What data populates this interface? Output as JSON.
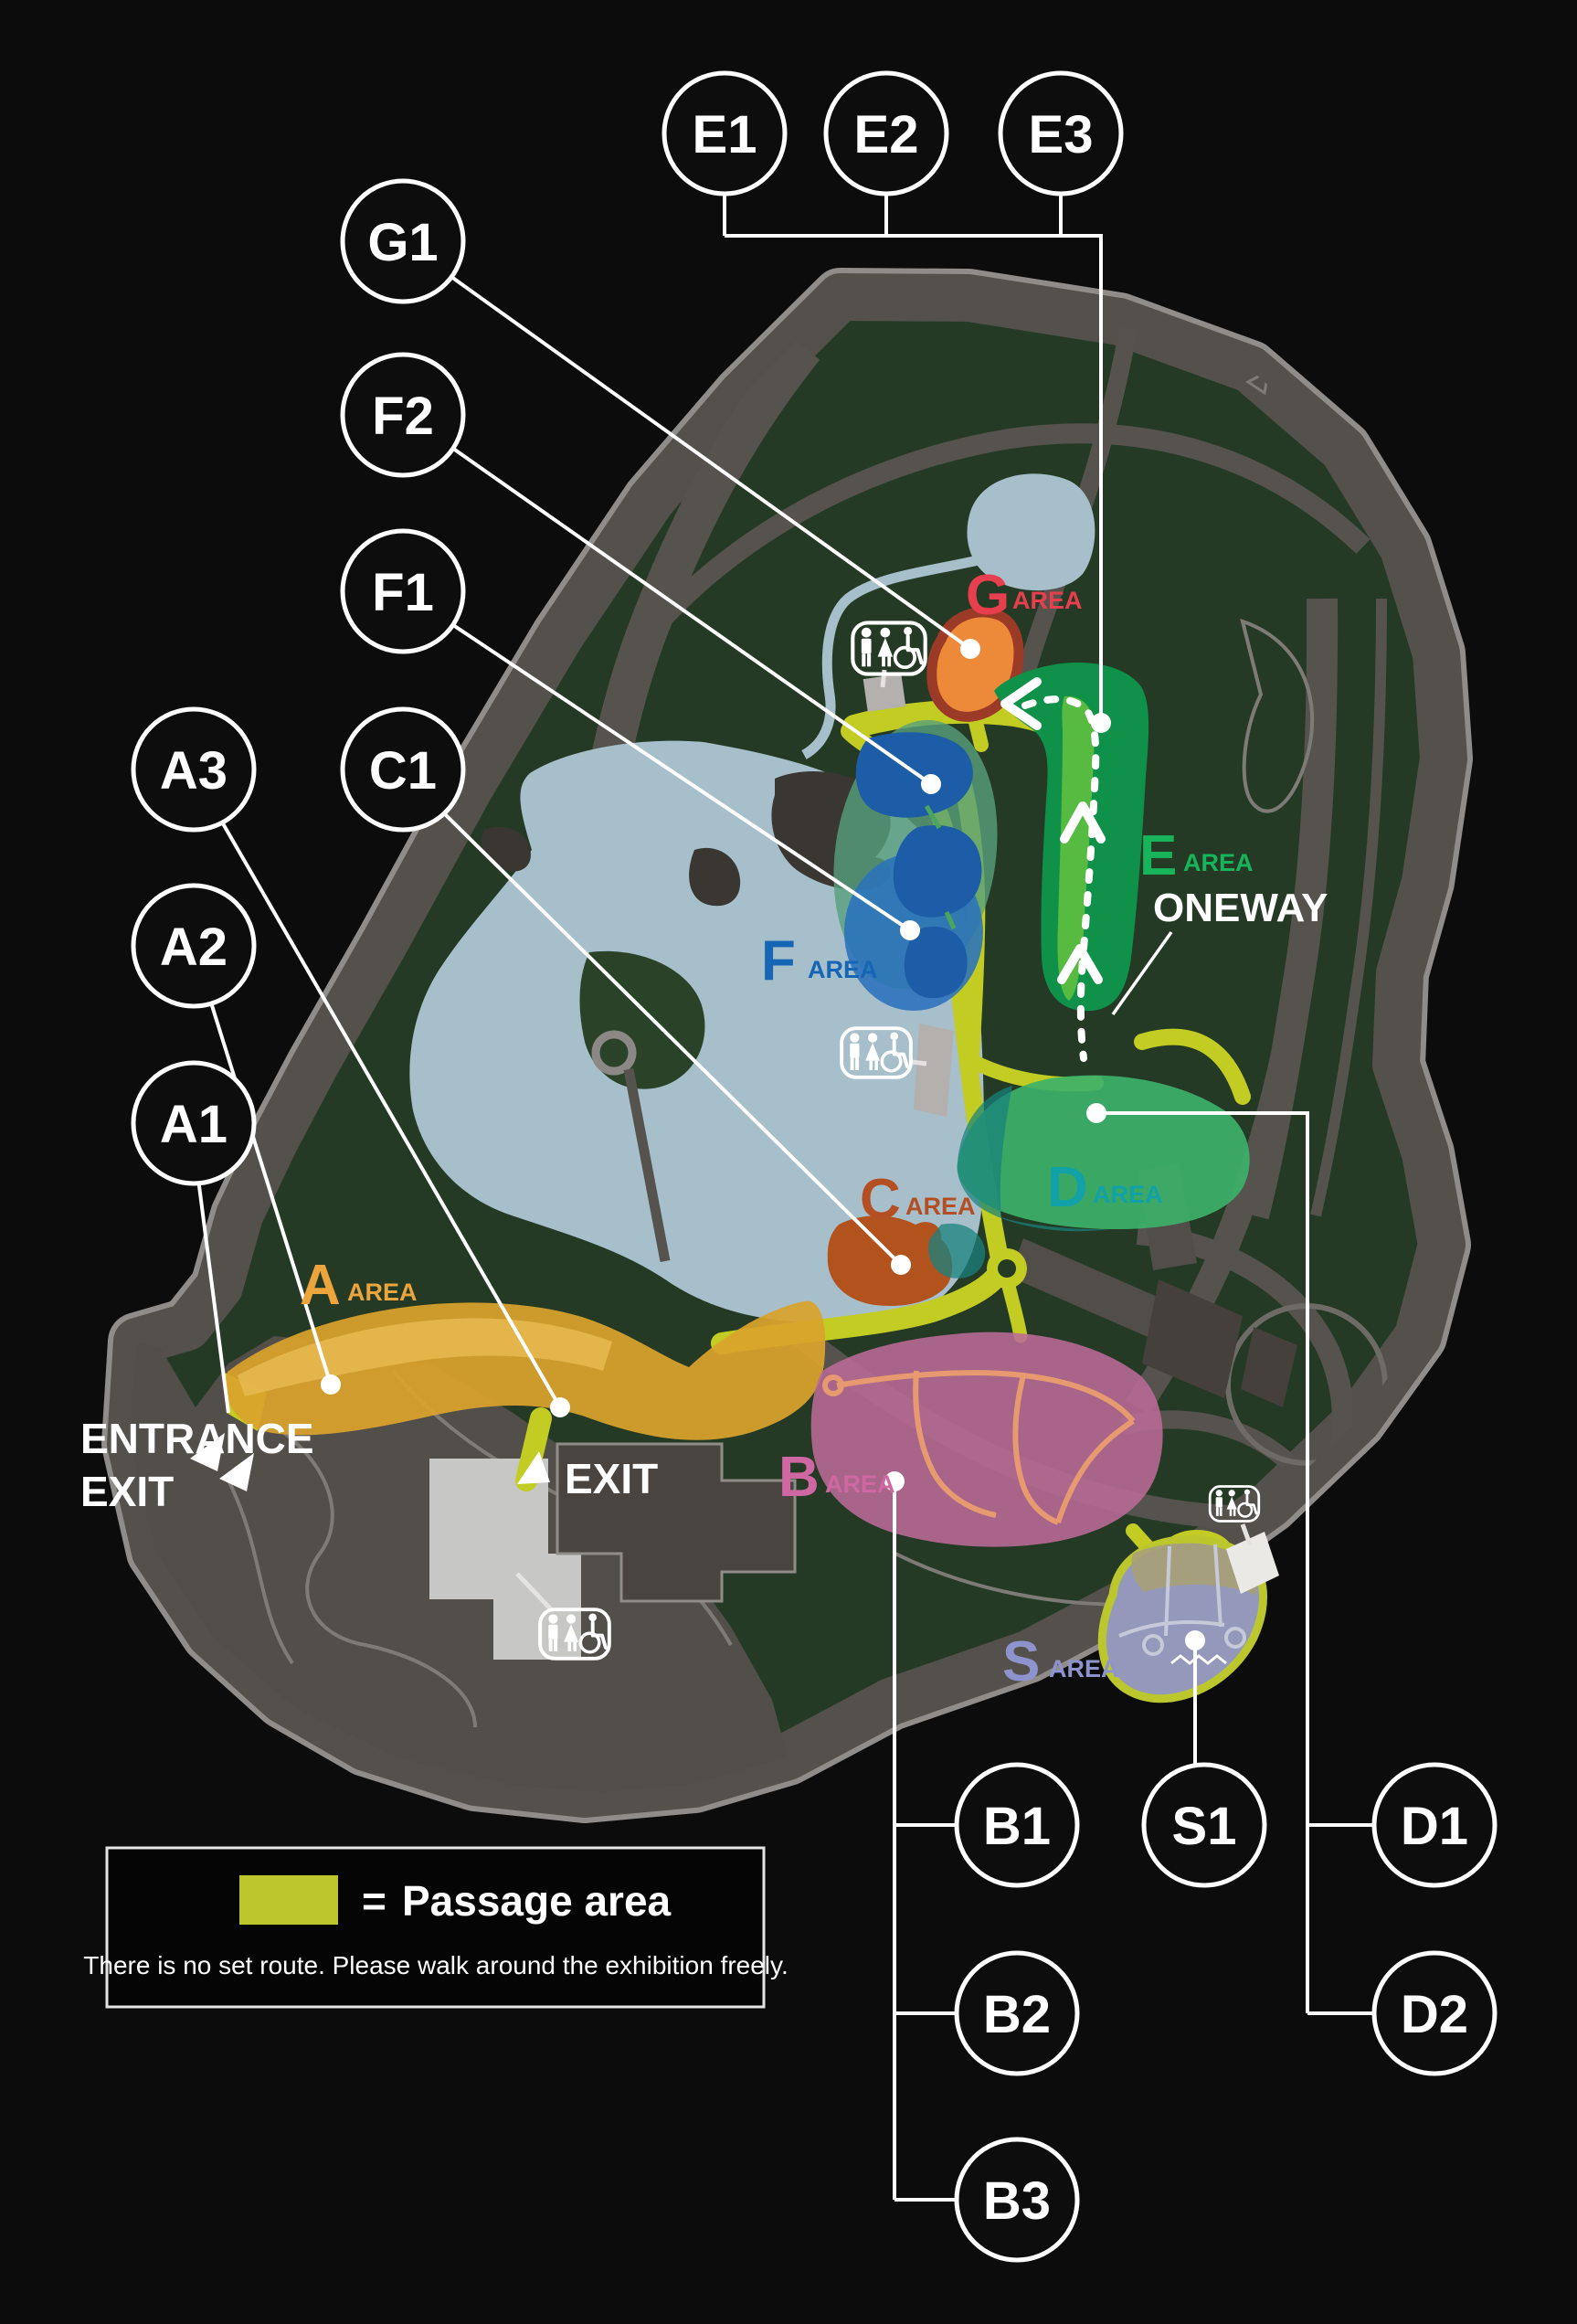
{
  "stations": {
    "e1": "E1",
    "e2": "E2",
    "e3": "E3",
    "g1": "G1",
    "f2": "F2",
    "f1": "F1",
    "a3": "A3",
    "c1": "C1",
    "a2": "A2",
    "a1": "A1",
    "b1": "B1",
    "s1": "S1",
    "d1": "D1",
    "b2": "B2",
    "d2": "D2",
    "b3": "B3"
  },
  "areas": {
    "a": {
      "letter": "A",
      "suffix": "AREA",
      "color": "#eca43c"
    },
    "b": {
      "letter": "B",
      "suffix": "AREA",
      "color": "#cf67a2"
    },
    "c": {
      "letter": "C",
      "suffix": "AREA",
      "color": "#b44f24"
    },
    "d": {
      "letter": "D",
      "suffix": "AREA",
      "color": "#12a1a6"
    },
    "e": {
      "letter": "E",
      "suffix": "AREA",
      "color": "#17b45c"
    },
    "f": {
      "letter": "F",
      "suffix": "AREA",
      "color": "#1765b5"
    },
    "g": {
      "letter": "G",
      "suffix": "AREA",
      "color": "#e83f4e"
    },
    "s": {
      "letter": "S",
      "suffix": "AREA",
      "color": "#8f93cd"
    }
  },
  "labels": {
    "oneway": "ONEWAY",
    "entrance": "ENTRANCE",
    "exit": "EXIT",
    "exit_south": "EXIT"
  },
  "legend": {
    "equals": "=",
    "passage_label": "Passage area",
    "note": "There is no set route. Please walk around the exhibition freely.",
    "swatch_color": "#bcc72e"
  },
  "colors": {
    "passage": "#c3cc22",
    "park_green": "#243a25",
    "lake": "#a6bfca",
    "road_gray": "#56524e"
  }
}
